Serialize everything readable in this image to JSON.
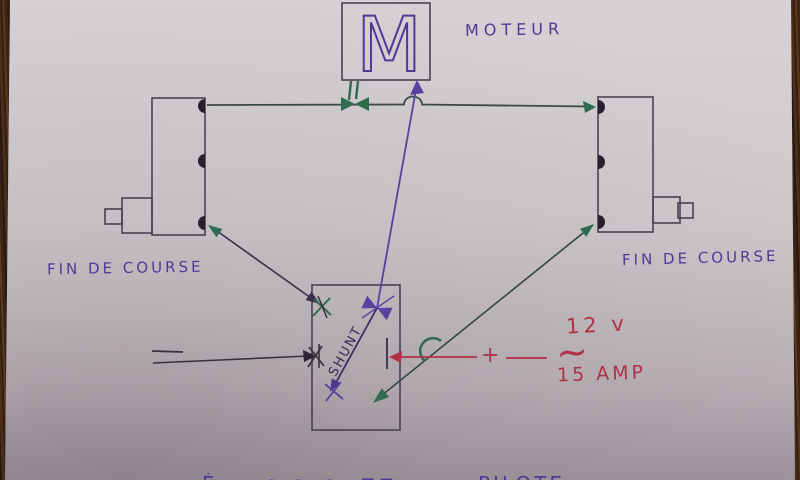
{
  "diagram": {
    "motor": {
      "symbol": "M",
      "label": "MOTEUR"
    },
    "limit_switch_left": {
      "label": "FIN DE COURSE"
    },
    "limit_switch_right": {
      "label": "FIN DE COURSE"
    },
    "shunt": {
      "label": "SHUNT"
    },
    "supply": {
      "voltage": "12 v",
      "ac_symbol": "~",
      "current": "15 AMP",
      "plus": "+"
    },
    "footer_fragments": [
      {
        "text": "É"
      },
      {
        "text": "∩ ∩"
      },
      {
        "text": "∩"
      },
      {
        "text": "⊓⊓"
      },
      {
        "text": "PILOTE"
      }
    ]
  },
  "colors": {
    "purple_ink": "#4c3b96",
    "green_ink": "#2e6b50",
    "red_ink": "#b13148",
    "dark_ink": "#38323f",
    "paper": "#cfc9cd",
    "wood": "#3a2414"
  }
}
